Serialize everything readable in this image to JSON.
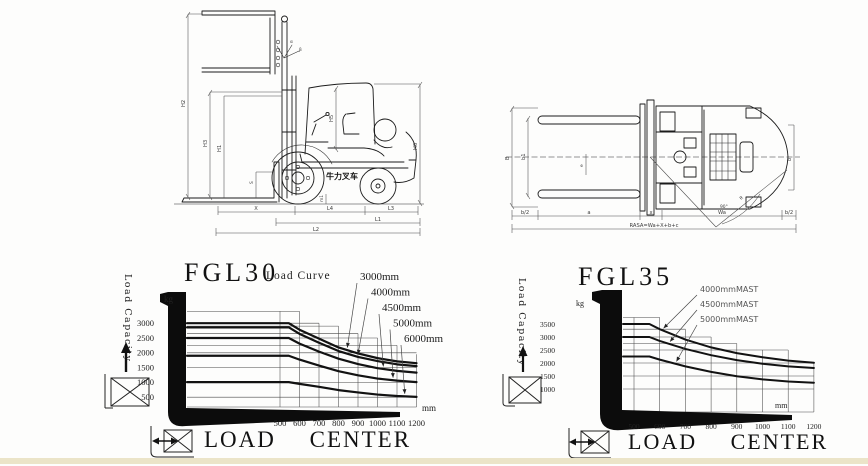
{
  "page": {
    "background": "#fdfdfc",
    "ink": "#1a1a1a",
    "bottom_strip_color": "#ebe4c8"
  },
  "side_view": {
    "brand": "牛力叉车",
    "labels": {
      "tall": "H2",
      "mid": "H3",
      "inner": "H1",
      "fork": "S",
      "cab": "H5",
      "right": "H6",
      "clearance": "m1",
      "tilt_front": "α",
      "tilt_rear": "β",
      "bottom1": [
        "X",
        "L4",
        "L3"
      ],
      "bottom2": "L1",
      "bottom3": "L2"
    }
  },
  "top_view": {
    "labels": {
      "outer": "B",
      "inner": "b1",
      "small": "e",
      "right": "b",
      "diag": "R",
      "angle": "90°",
      "bottom": [
        "b/2",
        "a",
        "x",
        "Wa",
        "b/2"
      ],
      "total": "RASA=Wa+X+b+c"
    }
  },
  "chart_data": [
    {
      "id": "fgl30",
      "type": "line",
      "title": "FGL30",
      "subtitle": "Load Curve",
      "ylabel": "Load Capacity",
      "y_unit": "kg",
      "x_unit": "mm",
      "xlabel": "LOAD CENTER",
      "xlim": [
        400,
        1250
      ],
      "ylim": [
        0,
        3400
      ],
      "x_ticks": [
        500,
        600,
        700,
        800,
        900,
        1000,
        1100,
        1200
      ],
      "y_ticks": [
        500,
        1000,
        1500,
        2000,
        2500,
        3000
      ],
      "x": [
        500,
        545,
        600,
        700,
        800,
        900,
        1000,
        1100,
        1200
      ],
      "series": [
        {
          "name": "3000mm",
          "values": [
            3000,
            3000,
            2780,
            2480,
            2180,
            1980,
            1820,
            1710,
            1650
          ],
          "pointer_mm": 845
        },
        {
          "name": "4000mm",
          "values": [
            2860,
            2860,
            2640,
            2340,
            2060,
            1860,
            1720,
            1610,
            1550
          ],
          "pointer_mm": 900
        },
        {
          "name": "4500mm",
          "values": [
            2500,
            2500,
            2310,
            2040,
            1800,
            1620,
            1480,
            1390,
            1330
          ],
          "pointer_mm": 1030
        },
        {
          "name": "5000mm",
          "values": [
            1900,
            1900,
            1770,
            1570,
            1380,
            1240,
            1130,
            1060,
            1010
          ],
          "pointer_mm": 1080
        },
        {
          "name": "6000mm",
          "values": [
            1010,
            1010,
            950,
            850,
            740,
            660,
            590,
            540,
            510
          ],
          "pointer_mm": 1140
        }
      ],
      "grid": {
        "v_tops": [
          3400,
          3400,
          3000,
          2900,
          2650,
          2500,
          2250,
          1950
        ],
        "h_lines": [
          {
            "kg": 3400,
            "end_mm": 600
          },
          {
            "kg": 3000,
            "end_mm": 700
          },
          {
            "kg": 2900,
            "end_mm": 800
          },
          {
            "kg": 2650,
            "end_mm": 900
          },
          {
            "kg": 2500,
            "end_mm": 1000
          },
          {
            "kg": 2250,
            "end_mm": 1100
          },
          {
            "kg": 2000,
            "end_mm": 1200
          },
          {
            "kg": 1500,
            "end_mm": 1200
          },
          {
            "kg": 1000,
            "end_mm": 1200
          },
          {
            "kg": 500,
            "end_mm": 1200
          }
        ]
      }
    },
    {
      "id": "fgl35",
      "type": "line",
      "title": "FGL35",
      "subtitle": "",
      "ylabel": "Load Capacity",
      "y_unit": "kg",
      "x_unit": "mm",
      "xlabel": "LOAD CENTER",
      "xlim": [
        400,
        1250
      ],
      "ylim": [
        0,
        3750
      ],
      "x_ticks": [
        500,
        600,
        700,
        800,
        900,
        1000,
        1100,
        1200
      ],
      "y_ticks": [
        1000,
        1500,
        2000,
        2500,
        3000,
        3500
      ],
      "x": [
        500,
        560,
        600,
        700,
        800,
        900,
        1000,
        1100,
        1200
      ],
      "series": [
        {
          "name": "4000mmMAST",
          "values": [
            3500,
            3500,
            3300,
            2900,
            2600,
            2380,
            2220,
            2090,
            2010
          ],
          "pointer_mm": 615
        },
        {
          "name": "4500mmMAST",
          "values": [
            3000,
            3000,
            2850,
            2540,
            2300,
            2110,
            1970,
            1870,
            1810
          ],
          "pointer_mm": 640
        },
        {
          "name": "5000mmMAST",
          "values": [
            2250,
            2250,
            2130,
            1870,
            1660,
            1490,
            1370,
            1290,
            1240
          ],
          "pointer_mm": 665
        }
      ],
      "grid": {
        "v_tops": [
          3750,
          3750,
          3300,
          3000,
          2750,
          2500,
          2500,
          2000
        ],
        "h_lines": [
          {
            "kg": 3750,
            "end_mm": 600
          },
          {
            "kg": 3300,
            "end_mm": 700
          },
          {
            "kg": 3000,
            "end_mm": 800
          },
          {
            "kg": 2750,
            "end_mm": 900
          },
          {
            "kg": 2500,
            "end_mm": 1100
          },
          {
            "kg": 2000,
            "end_mm": 1200
          },
          {
            "kg": 1500,
            "end_mm": 1200
          },
          {
            "kg": 1000,
            "end_mm": 1200
          }
        ]
      }
    }
  ]
}
